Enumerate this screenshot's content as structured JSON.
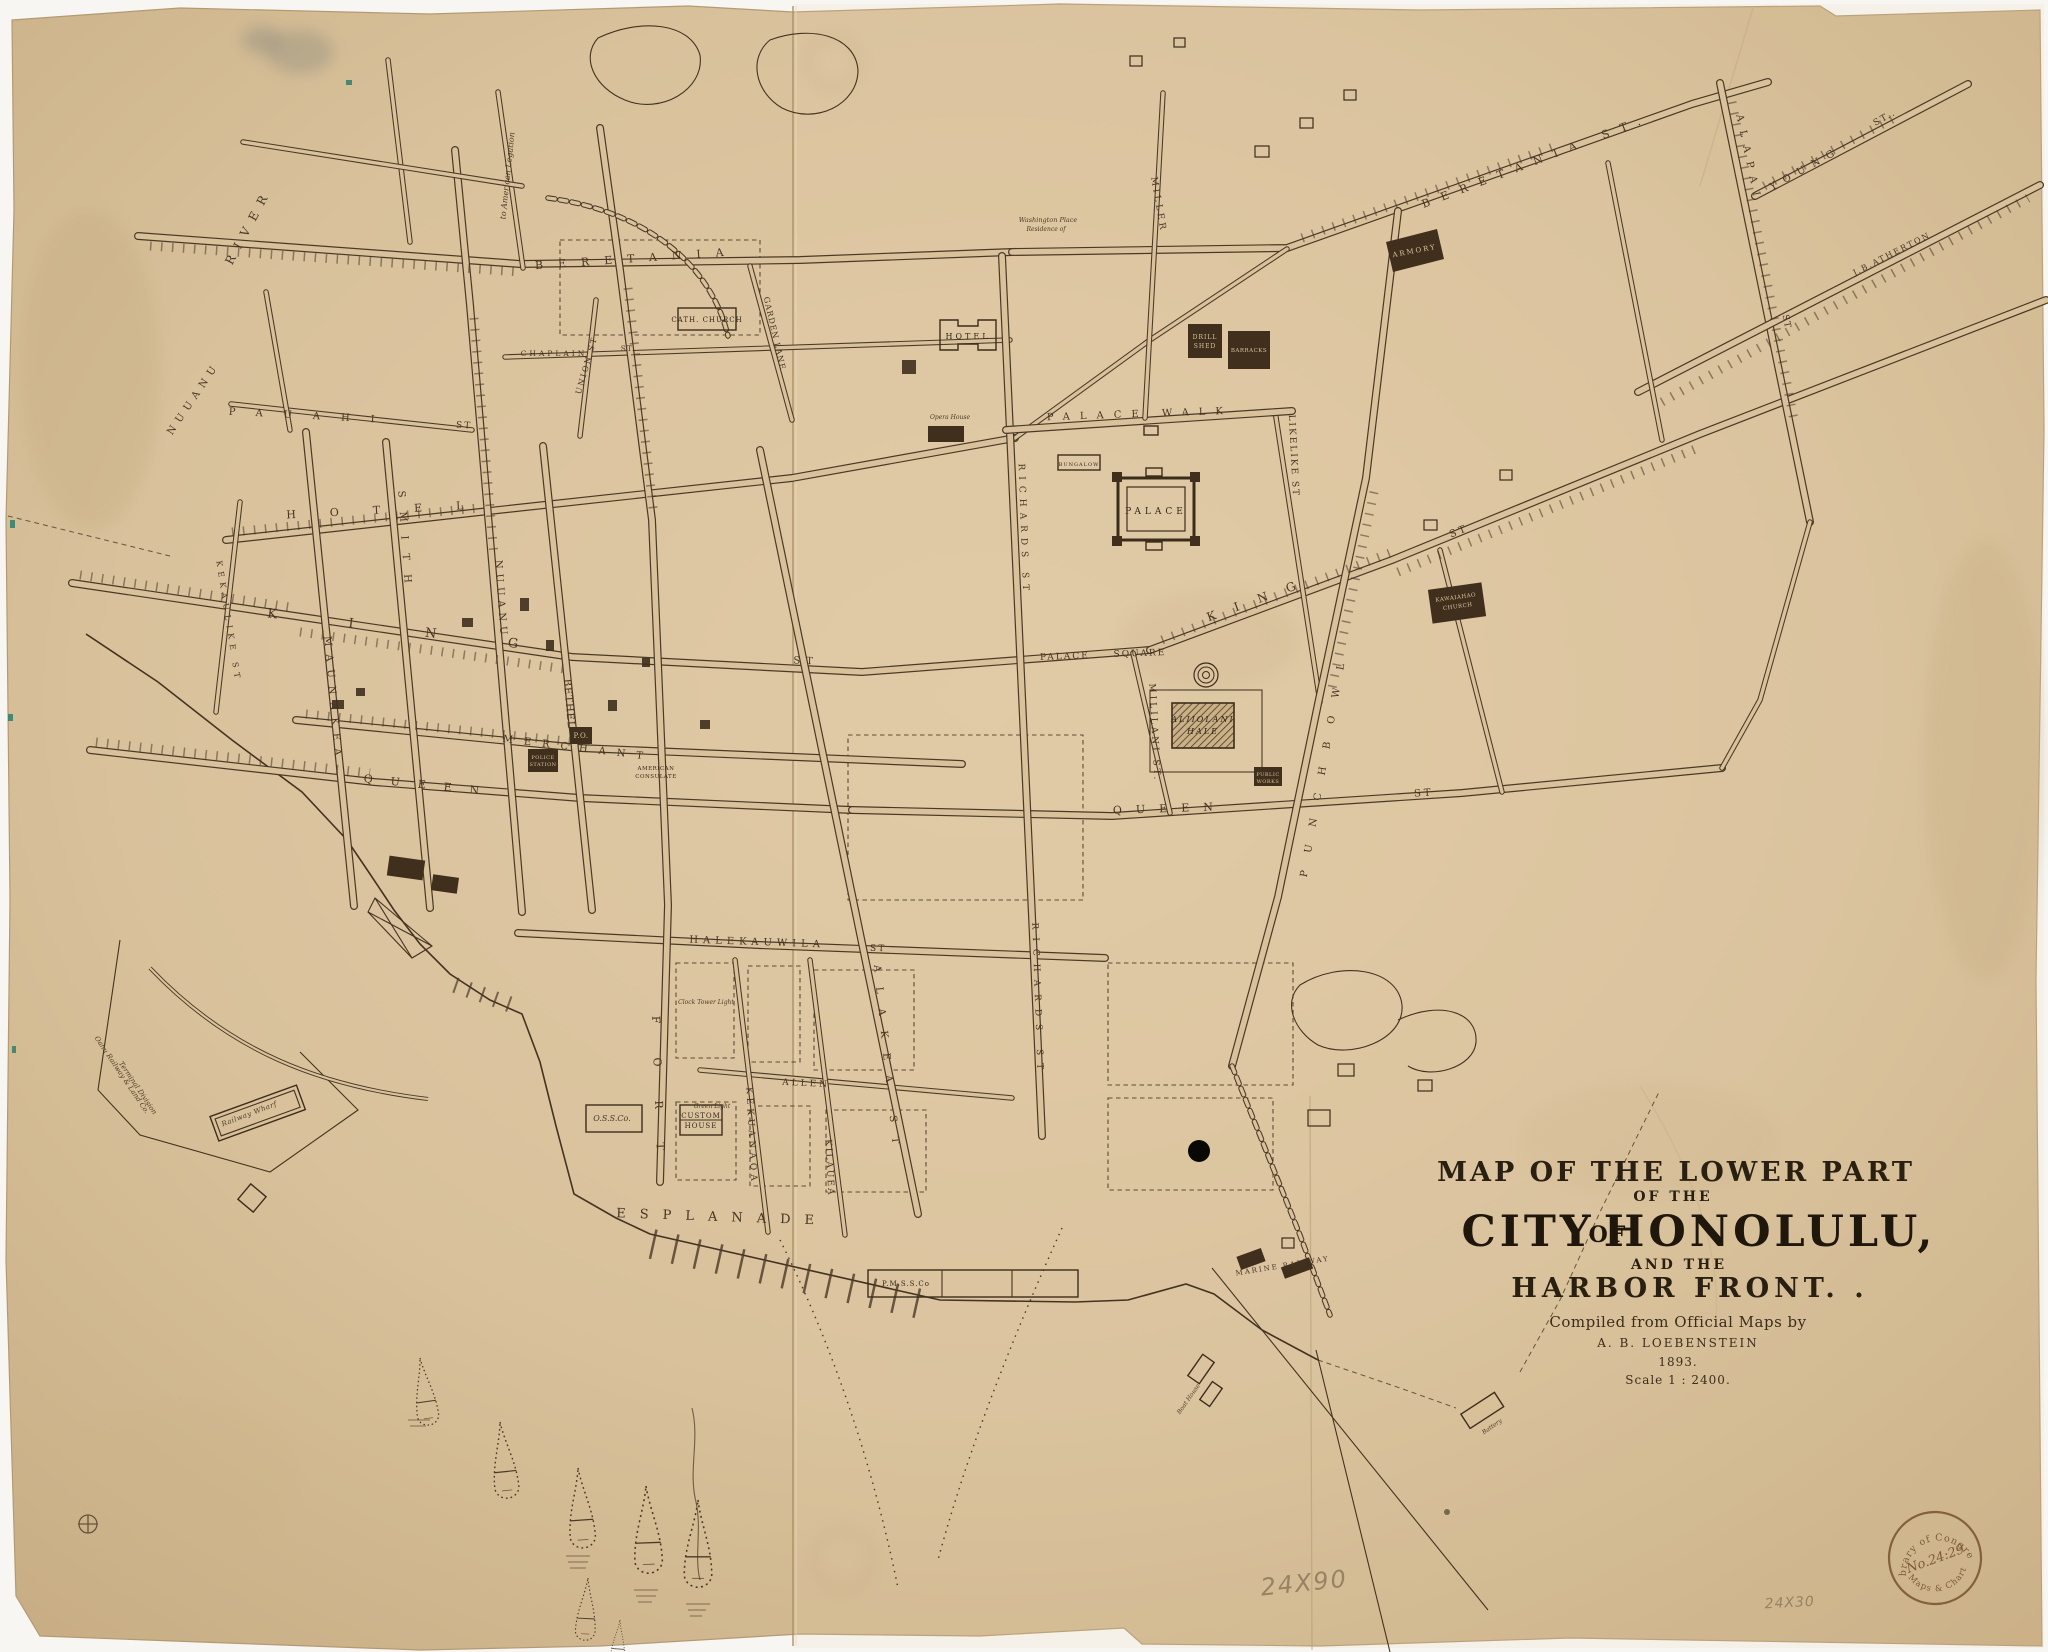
{
  "colors": {
    "paper": "#d8c19b",
    "ink": "#463523",
    "title_ink": "#241b10",
    "pencil": "#8d7a5b",
    "stamp": "#7d5a36"
  },
  "stamp": {
    "top": "Library of Congress",
    "number": "No.24:29",
    "bottom": "Maps & Charts"
  },
  "labels": {
    "streets": [
      {
        "n": "street-label-river",
        "t": "RIVER",
        "x": 252,
        "y": 228,
        "r": -62,
        "f": 12,
        "l": 9
      },
      {
        "n": "street-label-nuuanu-stream",
        "t": "NUUANU",
        "x": 196,
        "y": 400,
        "r": -56,
        "f": 10,
        "l": 6
      },
      {
        "n": "street-label-beretania",
        "t": "BERETANIA",
        "x": 637,
        "y": 262,
        "r": -4,
        "f": 11,
        "l": 15
      },
      {
        "n": "street-label-beretania-st",
        "t": "BERETANIA ST.",
        "x": 1538,
        "y": 164,
        "r": -21,
        "f": 11,
        "l": 12
      },
      {
        "n": "street-label-chaplain",
        "t": "CHAPLAIN",
        "x": 554,
        "y": 356,
        "r": 0,
        "f": 7.5,
        "l": 3
      },
      {
        "n": "street-label-chaplain-st",
        "t": "ST.",
        "x": 628,
        "y": 351,
        "r": 0,
        "f": 7.5,
        "l": 1
      },
      {
        "n": "street-label-pauahi",
        "t": "PAUAHI",
        "x": 312,
        "y": 419,
        "r": 3,
        "f": 10,
        "l": 21
      },
      {
        "n": "street-label-pauahi-st",
        "t": "ST",
        "x": 464,
        "y": 428,
        "r": 3,
        "f": 9,
        "l": 2
      },
      {
        "n": "street-label-hotel",
        "t": "HOTEL",
        "x": 392,
        "y": 513,
        "r": -3,
        "f": 11,
        "l": 34
      },
      {
        "n": "street-label-king",
        "t": "KING",
        "x": 428,
        "y": 637,
        "r": 7,
        "f": 13,
        "l": 72
      },
      {
        "n": "street-label-king-st",
        "t": "ST",
        "x": 806,
        "y": 664,
        "r": 2,
        "f": 10,
        "l": 6
      },
      {
        "n": "street-label-merchant",
        "t": "MERCHANT",
        "x": 578,
        "y": 751,
        "r": 7,
        "f": 10,
        "l": 11
      },
      {
        "n": "street-label-queen",
        "t": "QUEEN",
        "x": 430,
        "y": 789,
        "r": 6,
        "f": 11,
        "l": 18
      },
      {
        "n": "street-label-union",
        "t": "UNION ST",
        "x": 589,
        "y": 366,
        "r": -74,
        "f": 8,
        "l": 2
      },
      {
        "n": "note-american-legation",
        "t": "to American Legation",
        "x": 510,
        "y": 176,
        "r": -84,
        "f": 8,
        "l": 0,
        "c": "it"
      },
      {
        "n": "street-label-kekaulike",
        "t": "KEKAULIKE ST",
        "x": 226,
        "y": 622,
        "r": 81,
        "f": 8,
        "l": 5
      },
      {
        "n": "street-label-maunakea",
        "t": "MAUNAKEA",
        "x": 330,
        "y": 700,
        "r": 85,
        "f": 10,
        "l": 8
      },
      {
        "n": "street-label-smith",
        "t": "SMITH",
        "x": 402,
        "y": 544,
        "r": 86,
        "f": 10,
        "l": 14
      },
      {
        "n": "street-label-nuuanu",
        "t": "NUUANU",
        "x": 498,
        "y": 600,
        "r": 86,
        "f": 10,
        "l": 5
      },
      {
        "n": "street-label-bethel",
        "t": "BETHEL",
        "x": 566,
        "y": 704,
        "r": 85,
        "f": 10,
        "l": 1
      },
      {
        "n": "street-label-fort",
        "t": "FORT",
        "x": 655,
        "y": 1100,
        "r": 88,
        "f": 11,
        "l": 34
      },
      {
        "n": "street-label-alakea",
        "t": "ALAKEA ST",
        "x": 884,
        "y": 1062,
        "r": 84,
        "f": 10,
        "l": 15
      },
      {
        "n": "street-label-richards-upper",
        "t": "RICHARDS ST",
        "x": 1021,
        "y": 530,
        "r": 88,
        "f": 9,
        "l": 6
      },
      {
        "n": "street-label-richards",
        "t": "RICHARDS ST",
        "x": 1035,
        "y": 1000,
        "r": 88,
        "f": 9,
        "l": 8
      },
      {
        "n": "street-label-mililani",
        "t": "MILILANI ST.",
        "x": 1152,
        "y": 733,
        "r": 87,
        "f": 9,
        "l": 3
      },
      {
        "n": "street-label-likelike",
        "t": "LIKELIKE ST",
        "x": 1291,
        "y": 456,
        "r": 87,
        "f": 9,
        "l": 2
      },
      {
        "n": "street-label-punchbowl",
        "t": "PUNCHBOWL",
        "x": 1327,
        "y": 762,
        "r": -80,
        "f": 10,
        "l": 18
      },
      {
        "n": "street-label-palace-walk",
        "t": "PALACE WALK",
        "x": 1140,
        "y": 417,
        "r": -2,
        "f": 10,
        "l": 10
      },
      {
        "n": "street-label-palace-square-1",
        "t": "PALACE",
        "x": 1065,
        "y": 659,
        "r": -2,
        "f": 9,
        "l": 2
      },
      {
        "n": "street-label-palace-square-2",
        "t": "SQUARE",
        "x": 1140,
        "y": 656,
        "r": -2,
        "f": 9,
        "l": 2
      },
      {
        "n": "street-label-queen-east",
        "t": "QUEEN",
        "x": 1170,
        "y": 812,
        "r": -2,
        "f": 11,
        "l": 14
      },
      {
        "n": "street-label-queen-east-st",
        "t": "ST",
        "x": 1424,
        "y": 796,
        "r": -4,
        "f": 10,
        "l": 3
      },
      {
        "n": "street-label-king-east",
        "t": "KING",
        "x": 1262,
        "y": 602,
        "r": -20,
        "f": 12,
        "l": 20
      },
      {
        "n": "street-label-king-east-st",
        "t": "ST",
        "x": 1460,
        "y": 534,
        "r": -22,
        "f": 10,
        "l": 3
      },
      {
        "n": "street-label-halekauwila",
        "t": "HALEKAUWILA",
        "x": 757,
        "y": 945,
        "r": 2,
        "f": 10,
        "l": 5
      },
      {
        "n": "street-label-halekauwila-st",
        "t": "ST",
        "x": 878,
        "y": 951,
        "r": 2,
        "f": 9,
        "l": 2
      },
      {
        "n": "street-label-allen",
        "t": "ALLEN",
        "x": 806,
        "y": 1086,
        "r": 3,
        "f": 9,
        "l": 3
      },
      {
        "n": "street-label-esplanade",
        "t": "ESPLANADE",
        "x": 722,
        "y": 1221,
        "r": 2,
        "f": 13,
        "l": 14
      },
      {
        "n": "street-label-kilauea",
        "t": "KILAUEA",
        "x": 827,
        "y": 1168,
        "r": 87,
        "f": 9,
        "l": 2
      },
      {
        "n": "street-label-kekuanaoa",
        "t": "KEKUANAOA",
        "x": 749,
        "y": 1136,
        "r": 87,
        "f": 9,
        "l": 4
      },
      {
        "n": "street-label-miller",
        "t": "MILLER",
        "x": 1156,
        "y": 205,
        "r": 80,
        "f": 9,
        "l": 3
      },
      {
        "n": "street-label-garden-lane",
        "t": "GARDEN LANE",
        "x": 772,
        "y": 334,
        "r": 77,
        "f": 8,
        "l": 1
      },
      {
        "n": "street-label-young",
        "t": "YOUNG",
        "x": 1807,
        "y": 171,
        "r": -29,
        "f": 10,
        "l": 8
      },
      {
        "n": "street-label-young-st",
        "t": "ST..",
        "x": 1886,
        "y": 120,
        "r": -29,
        "f": 9,
        "l": 2
      },
      {
        "n": "street-label-alapai",
        "t": "ALAPAI",
        "x": 1746,
        "y": 160,
        "r": 78,
        "f": 10,
        "l": 9
      },
      {
        "n": "street-label-alapai-st",
        "t": "ST",
        "x": 1784,
        "y": 322,
        "r": 78,
        "f": 9,
        "l": 1
      },
      {
        "n": "road-label-atherton",
        "t": "J.B.ATHERTON",
        "x": 1893,
        "y": 256,
        "r": -27,
        "f": 8,
        "l": 2
      }
    ],
    "places": [
      {
        "n": "place-washington-place",
        "t": "Washington Place",
        "x": 1048,
        "y": 222,
        "r": 0,
        "f": 6.5,
        "l": 0,
        "c": "it"
      },
      {
        "n": "place-washington-place-2",
        "t": "Residence of",
        "x": 1046,
        "y": 231,
        "r": 0,
        "f": 6,
        "l": 0,
        "c": "it"
      },
      {
        "n": "building-label-cath-church",
        "t": "CATH. CHURCH",
        "x": 707,
        "y": 322,
        "r": 0,
        "f": 7,
        "l": 1,
        "c": "b"
      },
      {
        "n": "building-label-hotel",
        "t": "HOTEL",
        "x": 968,
        "y": 339,
        "r": 0,
        "f": 8,
        "l": 3,
        "c": "b"
      },
      {
        "n": "building-label-palace",
        "t": "PALACE",
        "x": 1156,
        "y": 514,
        "r": 0,
        "f": 9,
        "l": 4,
        "c": "b"
      },
      {
        "n": "building-label-bungalow",
        "t": "BUNGALOW",
        "x": 1079,
        "y": 466,
        "r": 0,
        "f": 5,
        "l": 1,
        "c": "b"
      },
      {
        "n": "building-label-armory",
        "t": "ARMORY",
        "x": 1415,
        "y": 253,
        "r": -11,
        "f": 7,
        "l": 2,
        "c": "rev"
      },
      {
        "n": "building-label-drill-shed-1",
        "t": "DRILL",
        "x": 1205,
        "y": 339,
        "r": 0,
        "f": 6,
        "l": 1,
        "c": "rev"
      },
      {
        "n": "building-label-drill-shed-2",
        "t": "SHED",
        "x": 1205,
        "y": 348,
        "r": 0,
        "f": 6,
        "l": 1,
        "c": "rev"
      },
      {
        "n": "building-label-barracks",
        "t": "BARRACKS",
        "x": 1249,
        "y": 352,
        "r": 0,
        "f": 5.5,
        "l": 0.5,
        "c": "rev"
      },
      {
        "n": "building-label-aliiolani-1",
        "t": "ALIIOLANI",
        "x": 1203,
        "y": 722,
        "r": 0,
        "f": 8,
        "l": 2,
        "c": "bit"
      },
      {
        "n": "building-label-aliiolani-2",
        "t": "HALE",
        "x": 1203,
        "y": 734,
        "r": 0,
        "f": 8,
        "l": 2,
        "c": "bit"
      },
      {
        "n": "building-label-kawaiahao-1",
        "t": "KAWAIAHAO",
        "x": 1456,
        "y": 599,
        "r": -8,
        "f": 5.5,
        "l": 0.5,
        "c": "rev"
      },
      {
        "n": "building-label-kawaiahao-2",
        "t": "CHURCH",
        "x": 1458,
        "y": 608,
        "r": -8,
        "f": 5.5,
        "l": 0.5,
        "c": "rev"
      },
      {
        "n": "building-label-public-works-1",
        "t": "PUBLIC",
        "x": 1268,
        "y": 776,
        "r": 0,
        "f": 5,
        "l": 0.5,
        "c": "rev"
      },
      {
        "n": "building-label-public-works-2",
        "t": "WORKS",
        "x": 1268,
        "y": 783,
        "r": 0,
        "f": 5,
        "l": 0.5,
        "c": "rev"
      },
      {
        "n": "building-label-post-office",
        "t": "P.O.",
        "x": 581,
        "y": 738,
        "r": 0,
        "f": 7,
        "l": 0.5,
        "c": "rev"
      },
      {
        "n": "building-label-police-1",
        "t": "POLICE",
        "x": 543,
        "y": 759,
        "r": 0,
        "f": 5,
        "l": 0.5,
        "c": "rev"
      },
      {
        "n": "building-label-police-2",
        "t": "STATION",
        "x": 543,
        "y": 766,
        "r": 0,
        "f": 5,
        "l": 0.5,
        "c": "rev"
      },
      {
        "n": "place-american-consulate-1",
        "t": "AMERICAN",
        "x": 656,
        "y": 770,
        "r": 0,
        "f": 5.5,
        "l": 0.5,
        "c": "b"
      },
      {
        "n": "place-american-consulate-2",
        "t": "CONSULATE",
        "x": 656,
        "y": 778,
        "r": 0,
        "f": 5.5,
        "l": 0.5,
        "c": "b"
      },
      {
        "n": "place-opera-house",
        "t": "Opera House",
        "x": 950,
        "y": 419,
        "r": 0,
        "f": 6,
        "l": 0,
        "c": "it"
      },
      {
        "n": "building-label-custom-house-1",
        "t": "CUSTOM",
        "x": 701,
        "y": 1118,
        "r": 0,
        "f": 7,
        "l": 1,
        "c": "b"
      },
      {
        "n": "building-label-custom-house-2",
        "t": "HOUSE",
        "x": 701,
        "y": 1128,
        "r": 0,
        "f": 7,
        "l": 1,
        "c": "b"
      },
      {
        "n": "building-label-oss",
        "t": "O.S.S.Co.",
        "x": 612,
        "y": 1121,
        "r": 0,
        "f": 8,
        "l": 0,
        "c": "it"
      },
      {
        "n": "note-green-light",
        "t": "Green Light",
        "x": 712,
        "y": 1108,
        "r": 0,
        "f": 6,
        "l": 0,
        "c": "it"
      },
      {
        "n": "note-clock-tower-light",
        "t": "Clock Tower Light",
        "x": 706,
        "y": 1004,
        "r": 0,
        "f": 6,
        "l": 0,
        "c": "it"
      },
      {
        "n": "building-label-pmss",
        "t": "P.M.S.S.Co",
        "x": 906,
        "y": 1286,
        "r": 0,
        "f": 7,
        "l": 1,
        "c": "b"
      },
      {
        "n": "place-marine-railway",
        "t": "MARINE RAILWAY",
        "x": 1283,
        "y": 1268,
        "r": -9,
        "f": 7,
        "l": 2
      },
      {
        "n": "place-battery",
        "t": "Battery",
        "x": 1493,
        "y": 1428,
        "r": -35,
        "f": 6,
        "l": 0,
        "c": "it"
      },
      {
        "n": "place-boat-house",
        "t": "Boat House",
        "x": 1190,
        "y": 1400,
        "r": -55,
        "f": 6,
        "l": 0,
        "c": "it"
      },
      {
        "n": "place-railway-wharf",
        "t": "Railway Wharf",
        "x": 250,
        "y": 1116,
        "r": -21,
        "f": 7,
        "l": 0.5,
        "c": "it"
      },
      {
        "n": "place-oahu-railway-1",
        "t": "Oahu Railway & Land Co.",
        "x": 120,
        "y": 1076,
        "r": 56,
        "f": 7,
        "l": 0,
        "c": "it"
      },
      {
        "n": "place-oahu-railway-2",
        "t": "Terminal Division",
        "x": 136,
        "y": 1089,
        "r": 56,
        "f": 7,
        "l": 0,
        "c": "it"
      }
    ],
    "title": [
      {
        "n": "title-line-1",
        "t": "MAP OF THE LOWER PART",
        "x": 1676,
        "y": 1181,
        "r": 0,
        "f": 27,
        "l": 3,
        "c": "t"
      },
      {
        "n": "title-line-2",
        "t": "OF THE",
        "x": 1673,
        "y": 1201,
        "r": 0,
        "f": 14,
        "l": 3,
        "c": "t"
      },
      {
        "n": "title-line-3a",
        "t": "CITY",
        "x": 1528,
        "y": 1246,
        "r": 0,
        "f": 43,
        "l": 4,
        "c": "ts"
      },
      {
        "n": "title-line-3b",
        "t": "OF",
        "x": 1608,
        "y": 1242,
        "r": 0,
        "f": 22,
        "l": 2,
        "c": "ts"
      },
      {
        "n": "title-line-3c",
        "t": "HONOLULU,",
        "x": 1770,
        "y": 1246,
        "r": 0,
        "f": 43,
        "l": 4,
        "c": "ts"
      },
      {
        "n": "title-line-4",
        "t": "AND THE",
        "x": 1679,
        "y": 1269,
        "r": 0,
        "f": 14,
        "l": 3,
        "c": "t"
      },
      {
        "n": "title-line-5",
        "t": "HARBOR FRONT. .",
        "x": 1690,
        "y": 1297,
        "r": 0,
        "f": 27,
        "l": 5,
        "c": "t"
      },
      {
        "n": "title-line-6",
        "t": "Compiled from Official Maps by",
        "x": 1678,
        "y": 1327,
        "r": 0,
        "f": 15,
        "l": 0.5,
        "c": "tc"
      },
      {
        "n": "title-line-7",
        "t": "A. B. LOEBENSTEIN",
        "x": 1678,
        "y": 1347,
        "r": 0,
        "f": 12,
        "l": 2,
        "c": "tc"
      },
      {
        "n": "title-line-8",
        "t": "1893.",
        "x": 1678,
        "y": 1366,
        "r": 0,
        "f": 12,
        "l": 1,
        "c": "tc"
      },
      {
        "n": "title-line-9",
        "t": "Scale    1 : 2400.",
        "x": 1678,
        "y": 1384,
        "r": 0,
        "f": 12,
        "l": 1,
        "c": "tc"
      }
    ],
    "notes": [
      {
        "n": "pencil-size-note",
        "t": "24X90",
        "x": 1305,
        "y": 1591,
        "r": -6,
        "f": 24,
        "l": 2,
        "c": "pencil"
      },
      {
        "n": "pencil-size-note-2",
        "t": "24X30",
        "x": 1790,
        "y": 1607,
        "r": -3,
        "f": 14,
        "l": 1,
        "c": "pencil"
      }
    ]
  }
}
